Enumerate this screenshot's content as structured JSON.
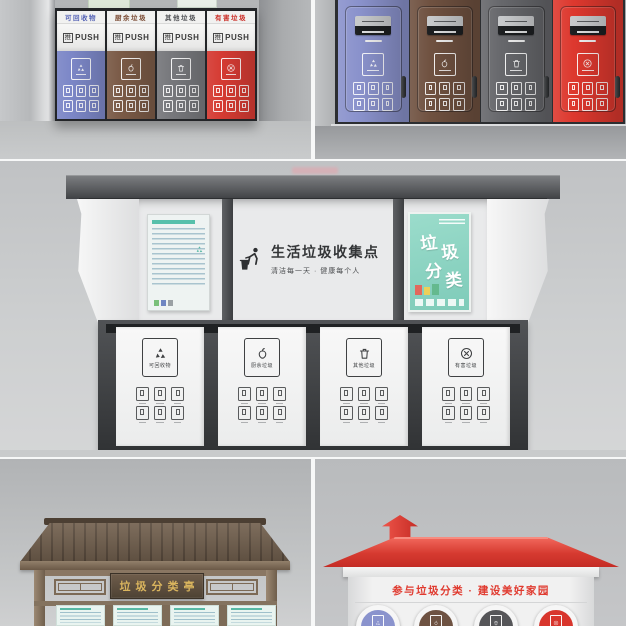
{
  "scene": {
    "description": "垃圾分类收集站三维渲染组图",
    "panel_count": 5
  },
  "labels": {
    "push_char": "推",
    "push_word": "PUSH"
  },
  "waste_categories": [
    {
      "name": "可回收物",
      "icon": "recycle-icon",
      "label_color": "#5563b5",
      "front_color": "#7c87c7",
      "side_color": "#8a92cc",
      "circle_color": "#8a93cd"
    },
    {
      "name": "厨余垃圾",
      "icon": "food-waste-icon",
      "label_color": "#7a4a33",
      "front_color": "#7a5a46",
      "side_color": "#6f5140",
      "circle_color": "#6e5242"
    },
    {
      "name": "其他垃圾",
      "icon": "other-waste-icon",
      "label_color": "#4f5054",
      "front_color": "#77787c",
      "side_color": "#66676b",
      "circle_color": "#565659"
    },
    {
      "name": "有害垃圾",
      "icon": "hazardous-icon",
      "label_color": "#cb2b24",
      "front_color": "#d53b33",
      "side_color": "#dd382e",
      "circle_color": "#d8352c"
    }
  ],
  "collection_station": {
    "title": "生活垃圾收集点",
    "subtitle": "清洁每一天 · 健康每个人",
    "poster_title": "垃圾分类",
    "poster_chars": [
      "垃",
      "圾",
      "分",
      "类"
    ]
  },
  "pavilion": {
    "plaque": "垃圾分类亭"
  },
  "red_station": {
    "slogan": "参与垃圾分类 · 建设美好家园",
    "roof_color": "#d63a30"
  },
  "palette": {
    "wood": "#6e5c4b",
    "poster_teal": "#8fd7c6",
    "plaque_gold": "#dab55e",
    "frame_dark": "#2c2e31"
  }
}
